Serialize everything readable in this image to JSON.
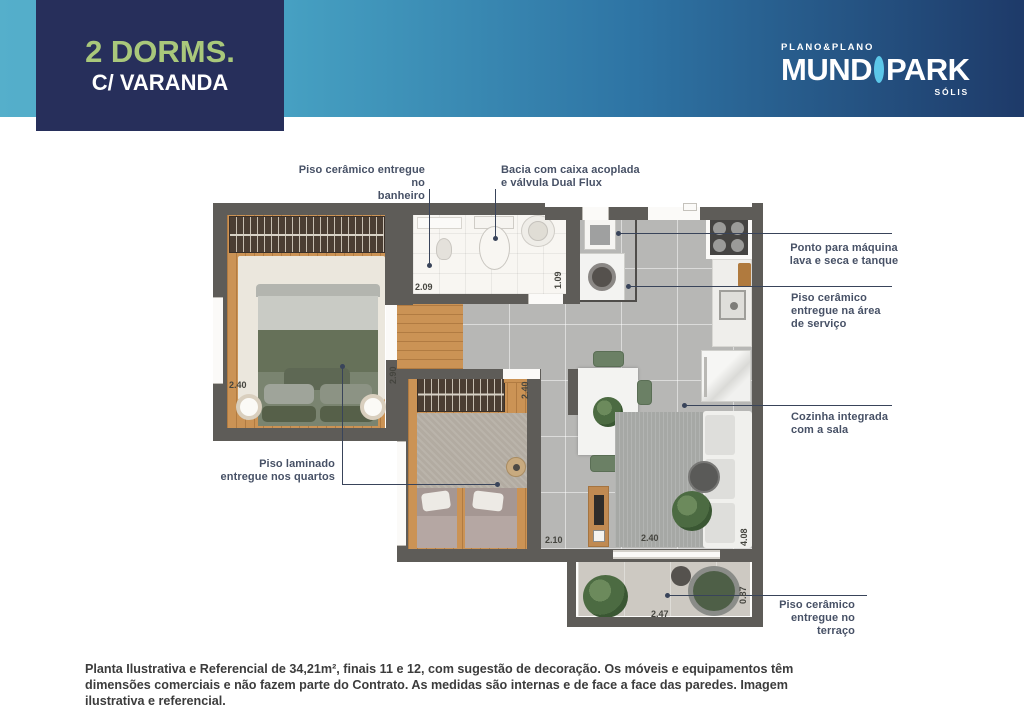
{
  "header": {
    "badge": {
      "title": "2 DORMS.",
      "subtitle": "C/ VARANDA"
    },
    "logo": {
      "brand": "PLANO&PLANO",
      "word_left": "MUND",
      "word_right": "PARK",
      "sub_brand": "SÓLIS"
    }
  },
  "plan": {
    "callouts": [
      {
        "text": "Piso cerâmico entregue no\nbanheiro",
        "x": 285,
        "y": 164,
        "w": 140,
        "align": "right"
      },
      {
        "text": "Bacia com caixa acoplada\ne válvula Dual Flux",
        "x": 501,
        "y": 164,
        "w": 155,
        "align": "left"
      },
      {
        "text": "Ponto para máquina\nlava e seca e tanque",
        "x": 786,
        "y": 242,
        "w": 116,
        "align": "center"
      },
      {
        "text": "Piso cerâmico\nentregue na área\nde serviço",
        "x": 791,
        "y": 292,
        "w": 120,
        "align": "left"
      },
      {
        "text": "Cozinha integrada\ncom a sala",
        "x": 791,
        "y": 411,
        "w": 120,
        "align": "left"
      },
      {
        "text": "Piso laminado\nentregue nos quartos",
        "x": 200,
        "y": 458,
        "w": 135,
        "align": "right"
      },
      {
        "text": "Piso cerâmico\nentregue no\nterraço",
        "x": 745,
        "y": 599,
        "w": 110,
        "align": "right"
      }
    ],
    "callout_lines": [
      {
        "x1": 429,
        "y1": 189,
        "x2": 429,
        "y2": 265,
        "dot": "end"
      },
      {
        "x1": 495,
        "y1": 189,
        "x2": 495,
        "y2": 238,
        "dot": "end"
      },
      {
        "x1": 618,
        "y1": 233,
        "x2": 892,
        "y2": 233,
        "dot": "start"
      },
      {
        "x1": 628,
        "y1": 286,
        "x2": 892,
        "y2": 286,
        "dot": "start"
      },
      {
        "x1": 684,
        "y1": 405,
        "x2": 892,
        "y2": 405,
        "dot": "start"
      },
      {
        "x1": 342,
        "y1": 366,
        "x2": 342,
        "y2": 484,
        "dot": "start"
      },
      {
        "x1": 342,
        "y1": 484,
        "x2": 497,
        "y2": 484,
        "dot": "end"
      },
      {
        "x1": 667,
        "y1": 595,
        "x2": 867,
        "y2": 595,
        "dot": "start"
      }
    ],
    "measurements": [
      {
        "v": "2.40",
        "x": 229,
        "y": 381,
        "rot": false
      },
      {
        "v": "2.90",
        "x": 389,
        "y": 384,
        "rot": true
      },
      {
        "v": "2.09",
        "x": 415,
        "y": 283,
        "rot": false
      },
      {
        "v": "1.09",
        "x": 554,
        "y": 289,
        "rot": true
      },
      {
        "v": "2.40",
        "x": 521,
        "y": 399,
        "rot": true
      },
      {
        "v": "2.10",
        "x": 545,
        "y": 536,
        "rot": false
      },
      {
        "v": "2.40",
        "x": 641,
        "y": 534,
        "rot": false
      },
      {
        "v": "4.08",
        "x": 740,
        "y": 546,
        "rot": true
      },
      {
        "v": "2.47",
        "x": 651,
        "y": 610,
        "rot": false
      },
      {
        "v": "0.87",
        "x": 739,
        "y": 604,
        "rot": true
      }
    ]
  },
  "footer": {
    "disclaimer": "Planta Ilustrativa e Referencial de 34,21m², finais 11 e 12, com sugestão de decoração. Os móveis e equipamentos têm dimensões comerciais e não fazem parte do Contrato. As medidas são internas e de face a face das paredes. Imagem ilustrativa e referencial."
  },
  "colors": {
    "band_left": "#55AFCB",
    "band_right": "#1E3A69",
    "badge_bg": "#272F5B",
    "badge_title": "#A9C87B",
    "badge_subtitle": "#FFFFFF",
    "logo_circle": "#5CC7E9",
    "wall": "#5E5C58",
    "wood_floor": "#CB9355",
    "tile_gray": "#B7B7B5",
    "callout_text": "#475166",
    "callout_line": "#39445A",
    "disclaimer_text": "#3C3C3C"
  }
}
